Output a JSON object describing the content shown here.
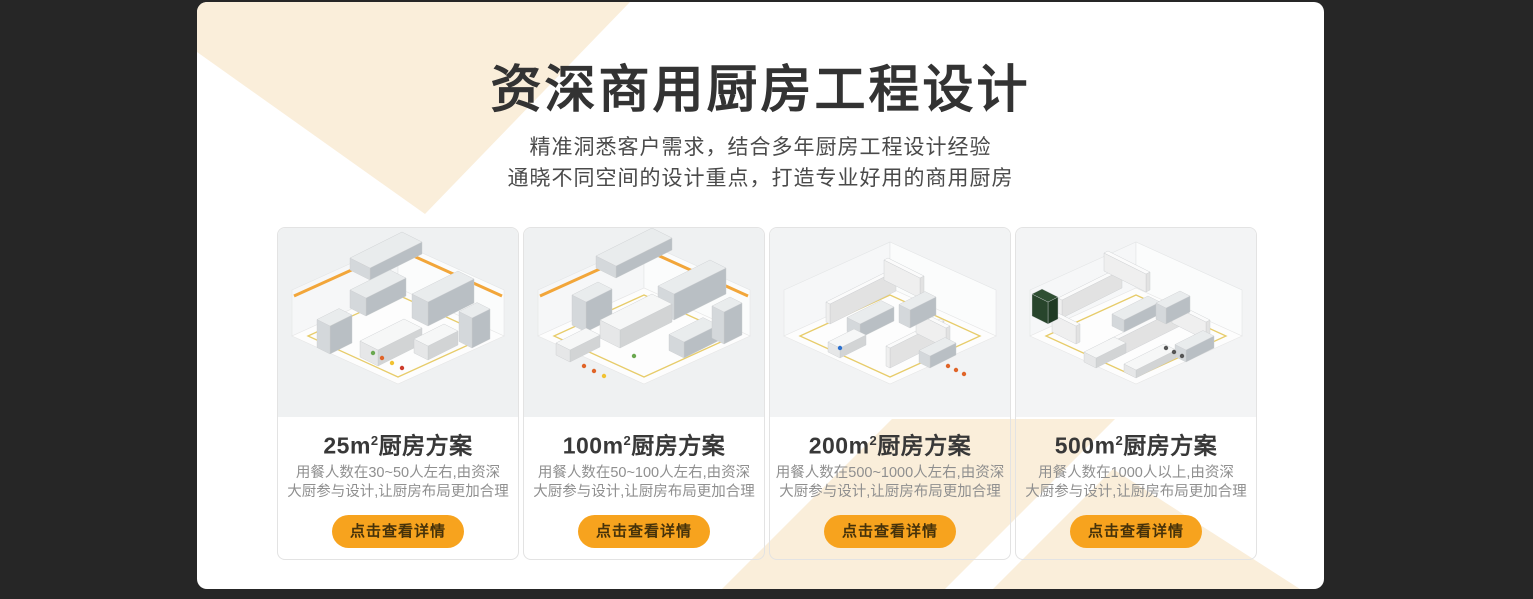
{
  "page": {
    "background": "#262626",
    "panel_background": "#ffffff",
    "accent_cream": "#FAEEDA",
    "title_color": "#333333",
    "subtitle_color": "#4A4A4A",
    "desc_color": "#8F8F8F"
  },
  "header": {
    "title": "资深商用厨房工程设计",
    "subtitle_line1": "精准洞悉客户需求，结合多年厨房工程设计经验",
    "subtitle_line2": "通晓不同空间的设计重点，打造专业好用的商用厨房"
  },
  "button": {
    "background": "#F7A31E",
    "text_color": "#46320A"
  },
  "cards": [
    {
      "title_num": "25m",
      "title_sup": "2",
      "title_rest": "厨房方案",
      "desc_line1": "用餐人数在30~50人左右,由资深",
      "desc_line2": "大厨参与设计,让厨房布局更加合理",
      "button_label": "点击查看详情",
      "image_name": "isometric-kitchen-render-25m2"
    },
    {
      "title_num": "100m",
      "title_sup": "2",
      "title_rest": "厨房方案",
      "desc_line1": "用餐人数在50~100人左右,由资深",
      "desc_line2": "大厨参与设计,让厨房布局更加合理",
      "button_label": "点击查看详情",
      "image_name": "isometric-kitchen-render-100m2"
    },
    {
      "title_num": "200m",
      "title_sup": "2",
      "title_rest": "厨房方案",
      "desc_line1": "用餐人数在500~1000人左右,由资深",
      "desc_line2": "大厨参与设计,让厨房布局更加合理",
      "button_label": "点击查看详情",
      "image_name": "isometric-kitchen-render-200m2"
    },
    {
      "title_num": "500m",
      "title_sup": "2",
      "title_rest": "厨房方案",
      "desc_line1": "用餐人数在1000人以上,由资深",
      "desc_line2": "大厨参与设计,让厨房布局更加合理",
      "button_label": "点击查看详情",
      "image_name": "isometric-kitchen-render-500m2"
    }
  ]
}
